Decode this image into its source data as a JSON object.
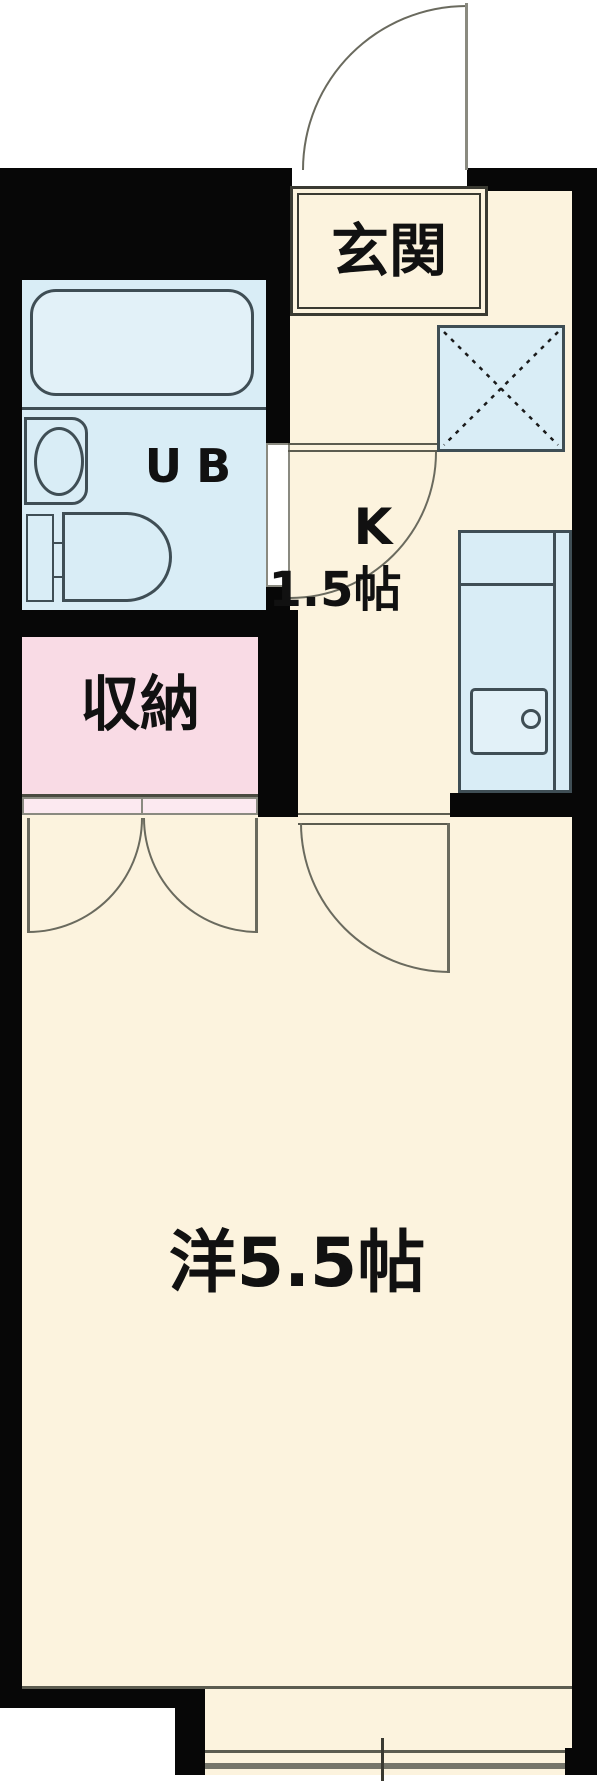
{
  "plan": {
    "type": "apartment-floor-plan",
    "labels": {
      "genkan": "玄関",
      "unit_bath": "UB",
      "kitchen_type": "K",
      "kitchen_size": "1.5帖",
      "closet": "収納",
      "main_room": "洋5.5帖"
    },
    "colors": {
      "wall": "#070707",
      "floor": "#fcf3de",
      "wet_area": "#d9edf6",
      "fixture_stroke": "#3f4e55",
      "closet_fill": "#f9dbe5",
      "closet_door_fill": "#fce9f0",
      "line": "#5c5c50",
      "arc": "#6a6a5e"
    }
  }
}
